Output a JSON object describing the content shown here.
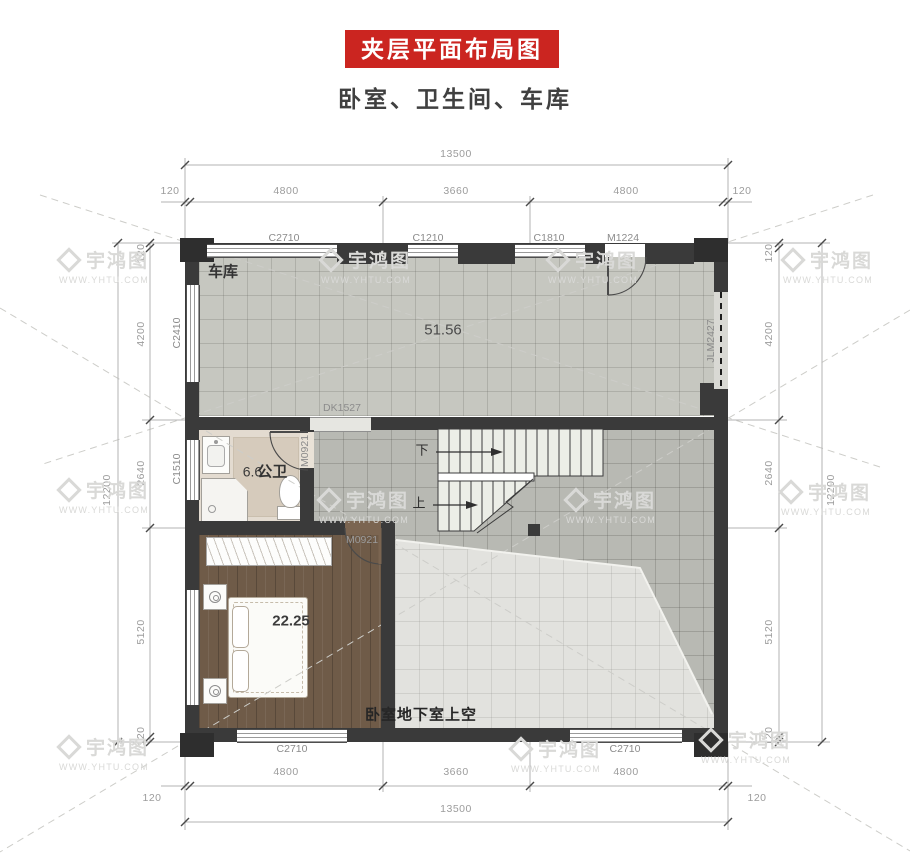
{
  "header": {
    "title": "夹层平面布局图",
    "subtitle": "卧室、卫生间、车库"
  },
  "rooms": {
    "garage": {
      "name": "车库",
      "area": "51.56"
    },
    "bathroom": {
      "name": "公卫",
      "area": "6.6"
    },
    "bedroom": {
      "area": "22.25"
    },
    "void": {
      "label": "卧室地下室上空"
    }
  },
  "stairs": {
    "down_label": "下",
    "up_label": "上"
  },
  "openings": {
    "top": [
      "C2710",
      "C1210",
      "C1810",
      "M1224"
    ],
    "left": [
      "C2410",
      "C1510"
    ],
    "right": [
      "JLM2427"
    ],
    "bottom": [
      "C2710",
      "C2710"
    ],
    "interior": {
      "dk": "DK1527",
      "bath_door": "M0921",
      "bedroom_door": "M0921"
    }
  },
  "dimensions": {
    "top": {
      "total": "13500",
      "segments": [
        "120",
        "4800",
        "3660",
        "4800",
        "120"
      ]
    },
    "bottom": {
      "total": "13500",
      "segments": [
        "4800",
        "3660",
        "4800"
      ],
      "edges": [
        "120",
        "120"
      ]
    },
    "left": {
      "total": "12200",
      "segments": [
        "120",
        "4200",
        "2640",
        "5120",
        "120"
      ]
    },
    "right": {
      "total": "12200",
      "segments": [
        "120",
        "4200",
        "2640",
        "5120",
        "120"
      ]
    }
  },
  "watermark": {
    "brand": "宇鸿图",
    "url": "WWW.YHTU.COM"
  },
  "colors": {
    "banner_red": "#cb2520",
    "wall": "#3a3a3a",
    "garage_floor": "#c6c7c0",
    "hall_floor": "#b8b9b3",
    "void_floor": "#e2e2de",
    "bath_floor": "#e3dbd0",
    "wood_floor": "#6f5b48"
  }
}
